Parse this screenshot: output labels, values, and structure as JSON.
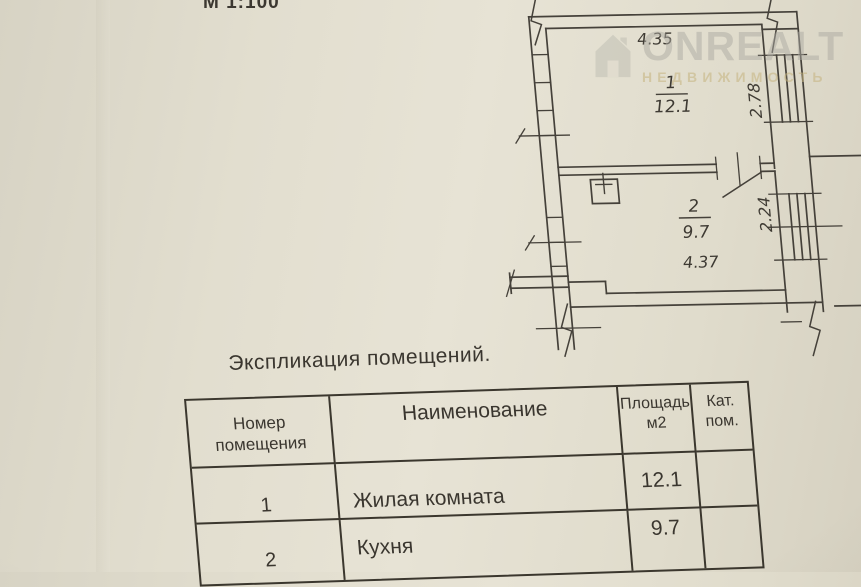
{
  "scale_label": "М 1:100",
  "watermark": {
    "brand": "ONREALT",
    "subtitle": "НЕДВИЖИМОСТЬ"
  },
  "plan": {
    "room1": {
      "number": "1",
      "area": "12.1",
      "width_dim": "4.35",
      "height_dim": "2.78"
    },
    "room2": {
      "number": "2",
      "area": "9.7",
      "width_dim": "4.37",
      "height_dim": "2.24"
    }
  },
  "table": {
    "title": "Экспликация помещений.",
    "headers": {
      "col1_line1": "Номер",
      "col1_line2": "помещения",
      "col2": "Наименование",
      "col3_line1": "Площадь",
      "col3_line2": "м2",
      "col4_line1": "Кат.",
      "col4_line2": "пом."
    },
    "rows": [
      {
        "number": "1",
        "name": "Жилая комната",
        "area": "12.1",
        "category": ""
      },
      {
        "number": "2",
        "name": "Кухня",
        "area": "9.7",
        "category": ""
      }
    ]
  },
  "colors": {
    "paper": "#e2decf",
    "ink": "#3b372e",
    "watermark_gray": "#adaba3",
    "watermark_tan": "#c4b27e"
  }
}
